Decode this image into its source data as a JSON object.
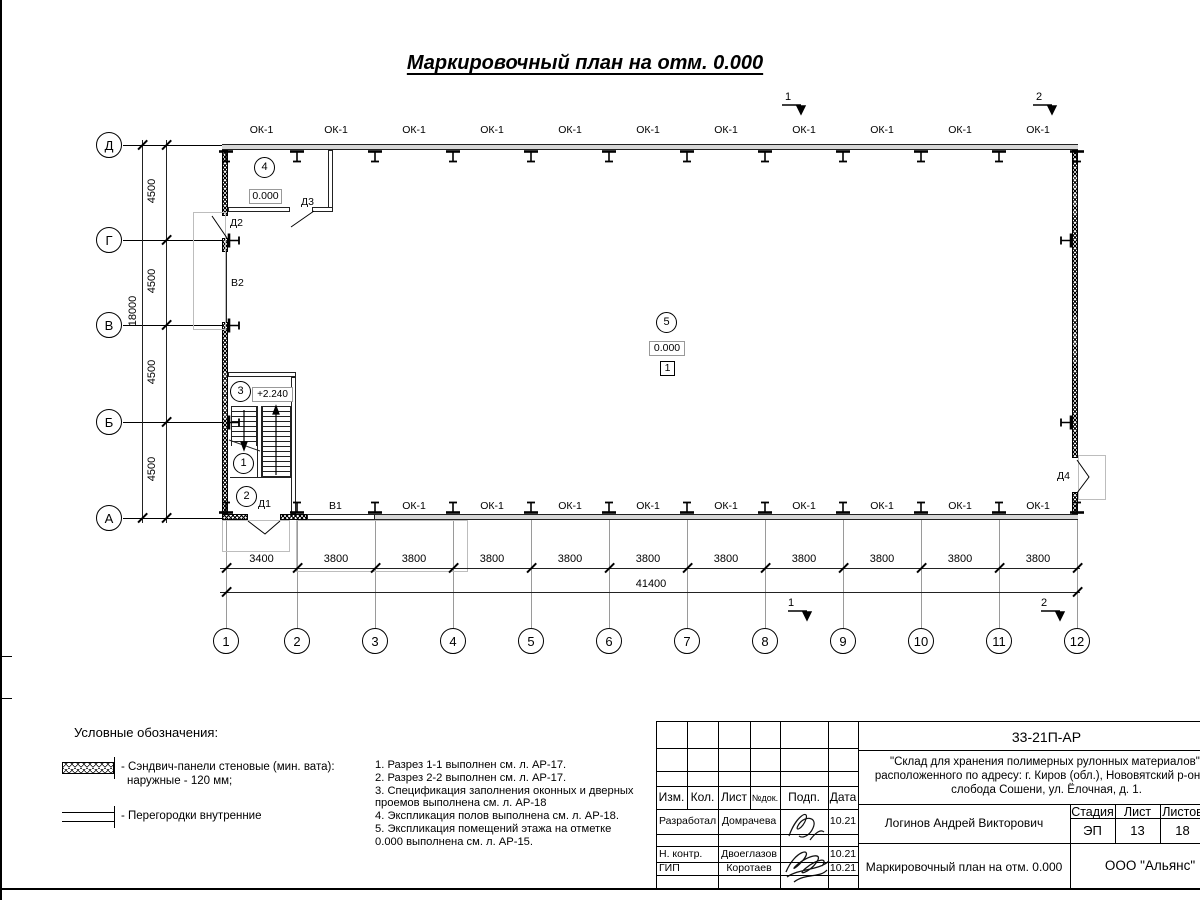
{
  "sheet": {
    "title": "Маркировочный план на отм. 0.000"
  },
  "plan": {
    "axis_rows": [
      "Д",
      "Г",
      "В",
      "Б",
      "А"
    ],
    "axis_cols": [
      "1",
      "2",
      "3",
      "4",
      "5",
      "6",
      "7",
      "8",
      "9",
      "10",
      "11",
      "12"
    ],
    "windows_top": [
      "ОК-1",
      "ОК-1",
      "ОК-1",
      "ОК-1",
      "ОК-1",
      "ОК-1",
      "ОК-1",
      "ОК-1",
      "ОК-1",
      "ОК-1",
      "ОК-1"
    ],
    "windows_bottom": [
      "ОК-1",
      "ОК-1",
      "ОК-1",
      "ОК-1",
      "ОК-1",
      "ОК-1",
      "ОК-1",
      "ОК-1",
      "ОК-1"
    ],
    "doors": {
      "d1": "Д1",
      "d2": "Д2",
      "d3": "Д3",
      "d4": "Д4"
    },
    "partitions": {
      "v1": "В1",
      "v2": "В2"
    },
    "rooms": {
      "r1": "1",
      "r2": "2",
      "r3": "3",
      "r4": "4",
      "r5": "5"
    },
    "elevations": {
      "vestibule": "0.000",
      "hall": "0.000",
      "stairs": "+2.240"
    },
    "floor_type_mark": "1",
    "section_marks": {
      "s1": "1",
      "s2": "2"
    },
    "dimensions": {
      "bottom_chain": [
        "3400",
        "3800",
        "3800",
        "3800",
        "3800",
        "3800",
        "3800",
        "3800",
        "3800",
        "3800",
        "3800"
      ],
      "bottom_total": "41400",
      "left_chain": [
        "4500",
        "4500",
        "4500",
        "4500"
      ],
      "left_total": "18000"
    }
  },
  "legend": {
    "heading": "Условные обозначения:",
    "item1_line1": "- Сэндвич-панели стеновые (мин. вата):",
    "item1_line2": "наружные - 120 мм;",
    "item2_line1": "- Перегородки внутренние"
  },
  "notes": {
    "lines": [
      "1. Разрез 1-1 выполнен см. л. АР-17.",
      "2. Разрез 2-2 выполнен см. л. АР-17.",
      "3. Спецификация заполнения оконных и дверных",
      "проемов выполнена см. л. АР-18",
      "4. Экспликация полов выполнена см. л. АР-18.",
      "5. Экспликация помещений этажа на отметке",
      "0.000 выполнена см. л. АР-15."
    ]
  },
  "titleblock": {
    "doc_code": "33-21П-АР",
    "project_line1": "\"Склад для хранения полимерных рулонных материалов\",",
    "project_line2": "расположенного по адресу: г. Киров (обл.), Нововятский р-он, те",
    "project_line3": "слобода Сошени, ул. Ёлочная, д. 1.",
    "header_cols": [
      "Изм.",
      "Кол.",
      "Лист",
      "№док.",
      "Подп.",
      "Дата"
    ],
    "rows": [
      {
        "role": "Разработал",
        "name": "Домрачева",
        "date": "10.21"
      },
      {
        "role": "Н. контр.",
        "name": "Двоеглазов",
        "date": "10.21"
      },
      {
        "role": "ГИП",
        "name": "Коротаев",
        "date": "10.21"
      }
    ],
    "approver": "Логинов Андрей Викторович",
    "sheet_caption": "Маркировочный план на отм. 0.000",
    "stage_header": [
      "Стадия",
      "Лист",
      "Листов"
    ],
    "stage_values": [
      "ЭП",
      "13",
      "18"
    ],
    "company": "ООО \"Альянс\""
  }
}
